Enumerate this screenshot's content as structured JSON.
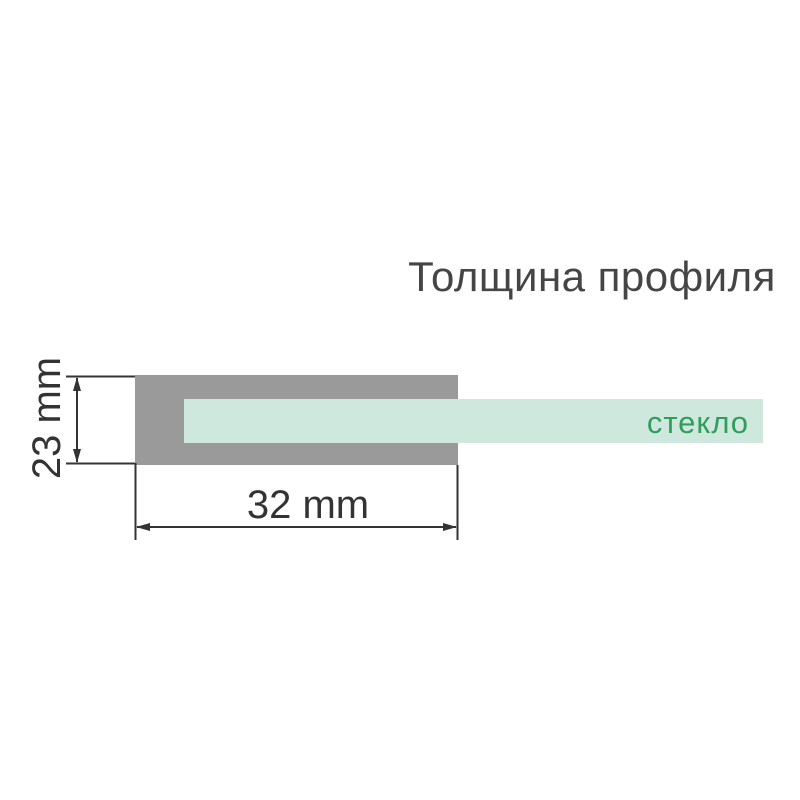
{
  "title": "Толщина профиля",
  "labels": {
    "height": "23 mm",
    "width": "32 mm",
    "glass": "стекло"
  },
  "colors": {
    "profile": "#9a9a9a",
    "glass": "#cfe8dd",
    "glass_text": "#2f9e5c",
    "title_text": "#454545",
    "dimension": "#333333"
  }
}
